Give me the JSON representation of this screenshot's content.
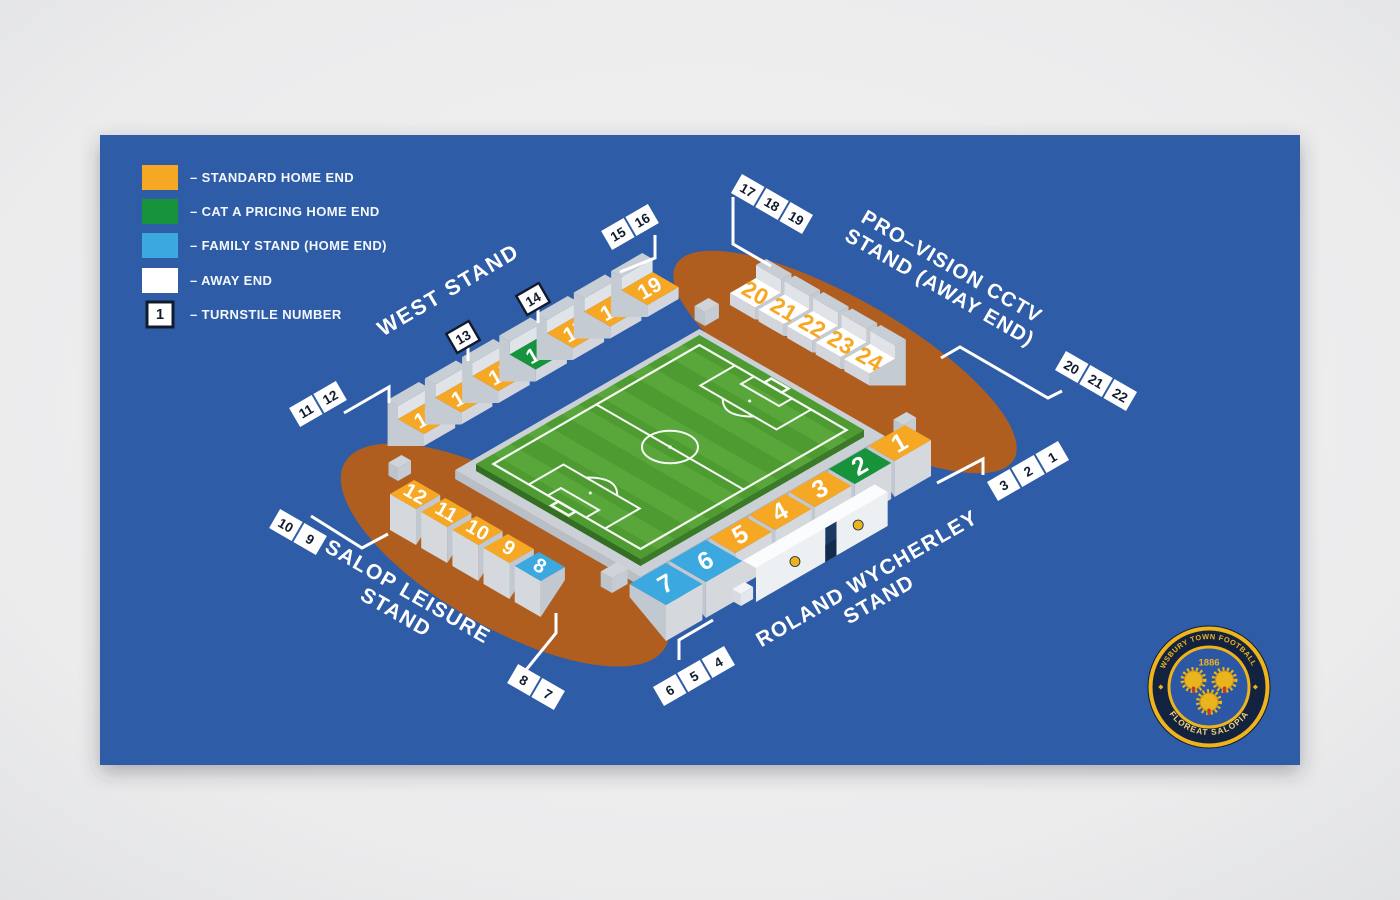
{
  "colors": {
    "page_bg": "#ECECED",
    "card": "#2E5BA6",
    "ground": "#B05E20",
    "standard": "#F6A824",
    "cat_a": "#17933B",
    "family": "#3BA8E0",
    "away": "#FFFFFF",
    "away_number": "#F6A824",
    "pitch_light": "#59A63B",
    "pitch_dark": "#4E9B31",
    "pitch_side": "#3A7A28",
    "line": "#FFFFFF",
    "tag_text": "#101B2E",
    "block_side": "#C5CBD3",
    "block_wall": "#D3D7DD"
  },
  "legend": {
    "items": [
      {
        "key": "standard",
        "label": "– STANDARD HOME END"
      },
      {
        "key": "cat_a",
        "label": "– CAT A PRICING HOME END"
      },
      {
        "key": "family",
        "label": "– FAMILY STAND (HOME END)"
      },
      {
        "key": "away",
        "label": "– AWAY END"
      }
    ],
    "turnstile_sample": "1",
    "turnstile_label": "– TURNSTILE NUMBER"
  },
  "stands": {
    "west": {
      "name_line1": "WEST STAND",
      "blocks": [
        {
          "n": "13",
          "cat": "standard"
        },
        {
          "n": "14",
          "cat": "standard"
        },
        {
          "n": "15",
          "cat": "standard"
        },
        {
          "n": "16",
          "cat": "cat_a"
        },
        {
          "n": "17",
          "cat": "standard"
        },
        {
          "n": "18",
          "cat": "standard"
        },
        {
          "n": "19",
          "cat": "standard"
        }
      ]
    },
    "away": {
      "name_line1": "PRO–VISION CCTV",
      "name_line2": "STAND (AWAY END)",
      "blocks": [
        {
          "n": "20",
          "cat": "away"
        },
        {
          "n": "21",
          "cat": "away"
        },
        {
          "n": "22",
          "cat": "away"
        },
        {
          "n": "23",
          "cat": "away"
        },
        {
          "n": "24",
          "cat": "away"
        }
      ]
    },
    "roland": {
      "name_line1": "ROLAND WYCHERLEY",
      "name_line2": "STAND",
      "blocks": [
        {
          "n": "1",
          "cat": "standard"
        },
        {
          "n": "2",
          "cat": "cat_a"
        },
        {
          "n": "3",
          "cat": "standard"
        },
        {
          "n": "4",
          "cat": "standard"
        },
        {
          "n": "5",
          "cat": "standard"
        },
        {
          "n": "6",
          "cat": "family"
        },
        {
          "n": "7",
          "cat": "family"
        }
      ]
    },
    "salop": {
      "name_line1": "SALOP LEISURE",
      "name_line2": "STAND",
      "blocks": [
        {
          "n": "12",
          "cat": "standard"
        },
        {
          "n": "11",
          "cat": "standard"
        },
        {
          "n": "10",
          "cat": "standard"
        },
        {
          "n": "9",
          "cat": "standard"
        },
        {
          "n": "8",
          "cat": "family"
        }
      ]
    }
  },
  "turnstile_tags": [
    {
      "id": "11-12",
      "numbers": [
        "11",
        "12"
      ],
      "bordered": false
    },
    {
      "id": "13",
      "numbers": [
        "13"
      ],
      "bordered": true
    },
    {
      "id": "14",
      "numbers": [
        "14"
      ],
      "bordered": true
    },
    {
      "id": "15-16",
      "numbers": [
        "15",
        "16"
      ],
      "bordered": false
    },
    {
      "id": "17-18-19",
      "numbers": [
        "17",
        "18",
        "19"
      ],
      "bordered": false
    },
    {
      "id": "20-21-22",
      "numbers": [
        "20",
        "21",
        "22"
      ],
      "bordered": false
    },
    {
      "id": "3-2-1",
      "numbers": [
        "3",
        "2",
        "1"
      ],
      "bordered": false
    },
    {
      "id": "6-5-4",
      "numbers": [
        "6",
        "5",
        "4"
      ],
      "bordered": false
    },
    {
      "id": "8-7",
      "numbers": [
        "8",
        "7"
      ],
      "bordered": false
    },
    {
      "id": "10-9",
      "numbers": [
        "10",
        "9"
      ],
      "bordered": false
    }
  ],
  "badge": {
    "top_text": "SHREWSBURY TOWN FOOTBALL CLUB",
    "bottom_text": "FLOREAT SALOPIA",
    "year": "1886"
  }
}
